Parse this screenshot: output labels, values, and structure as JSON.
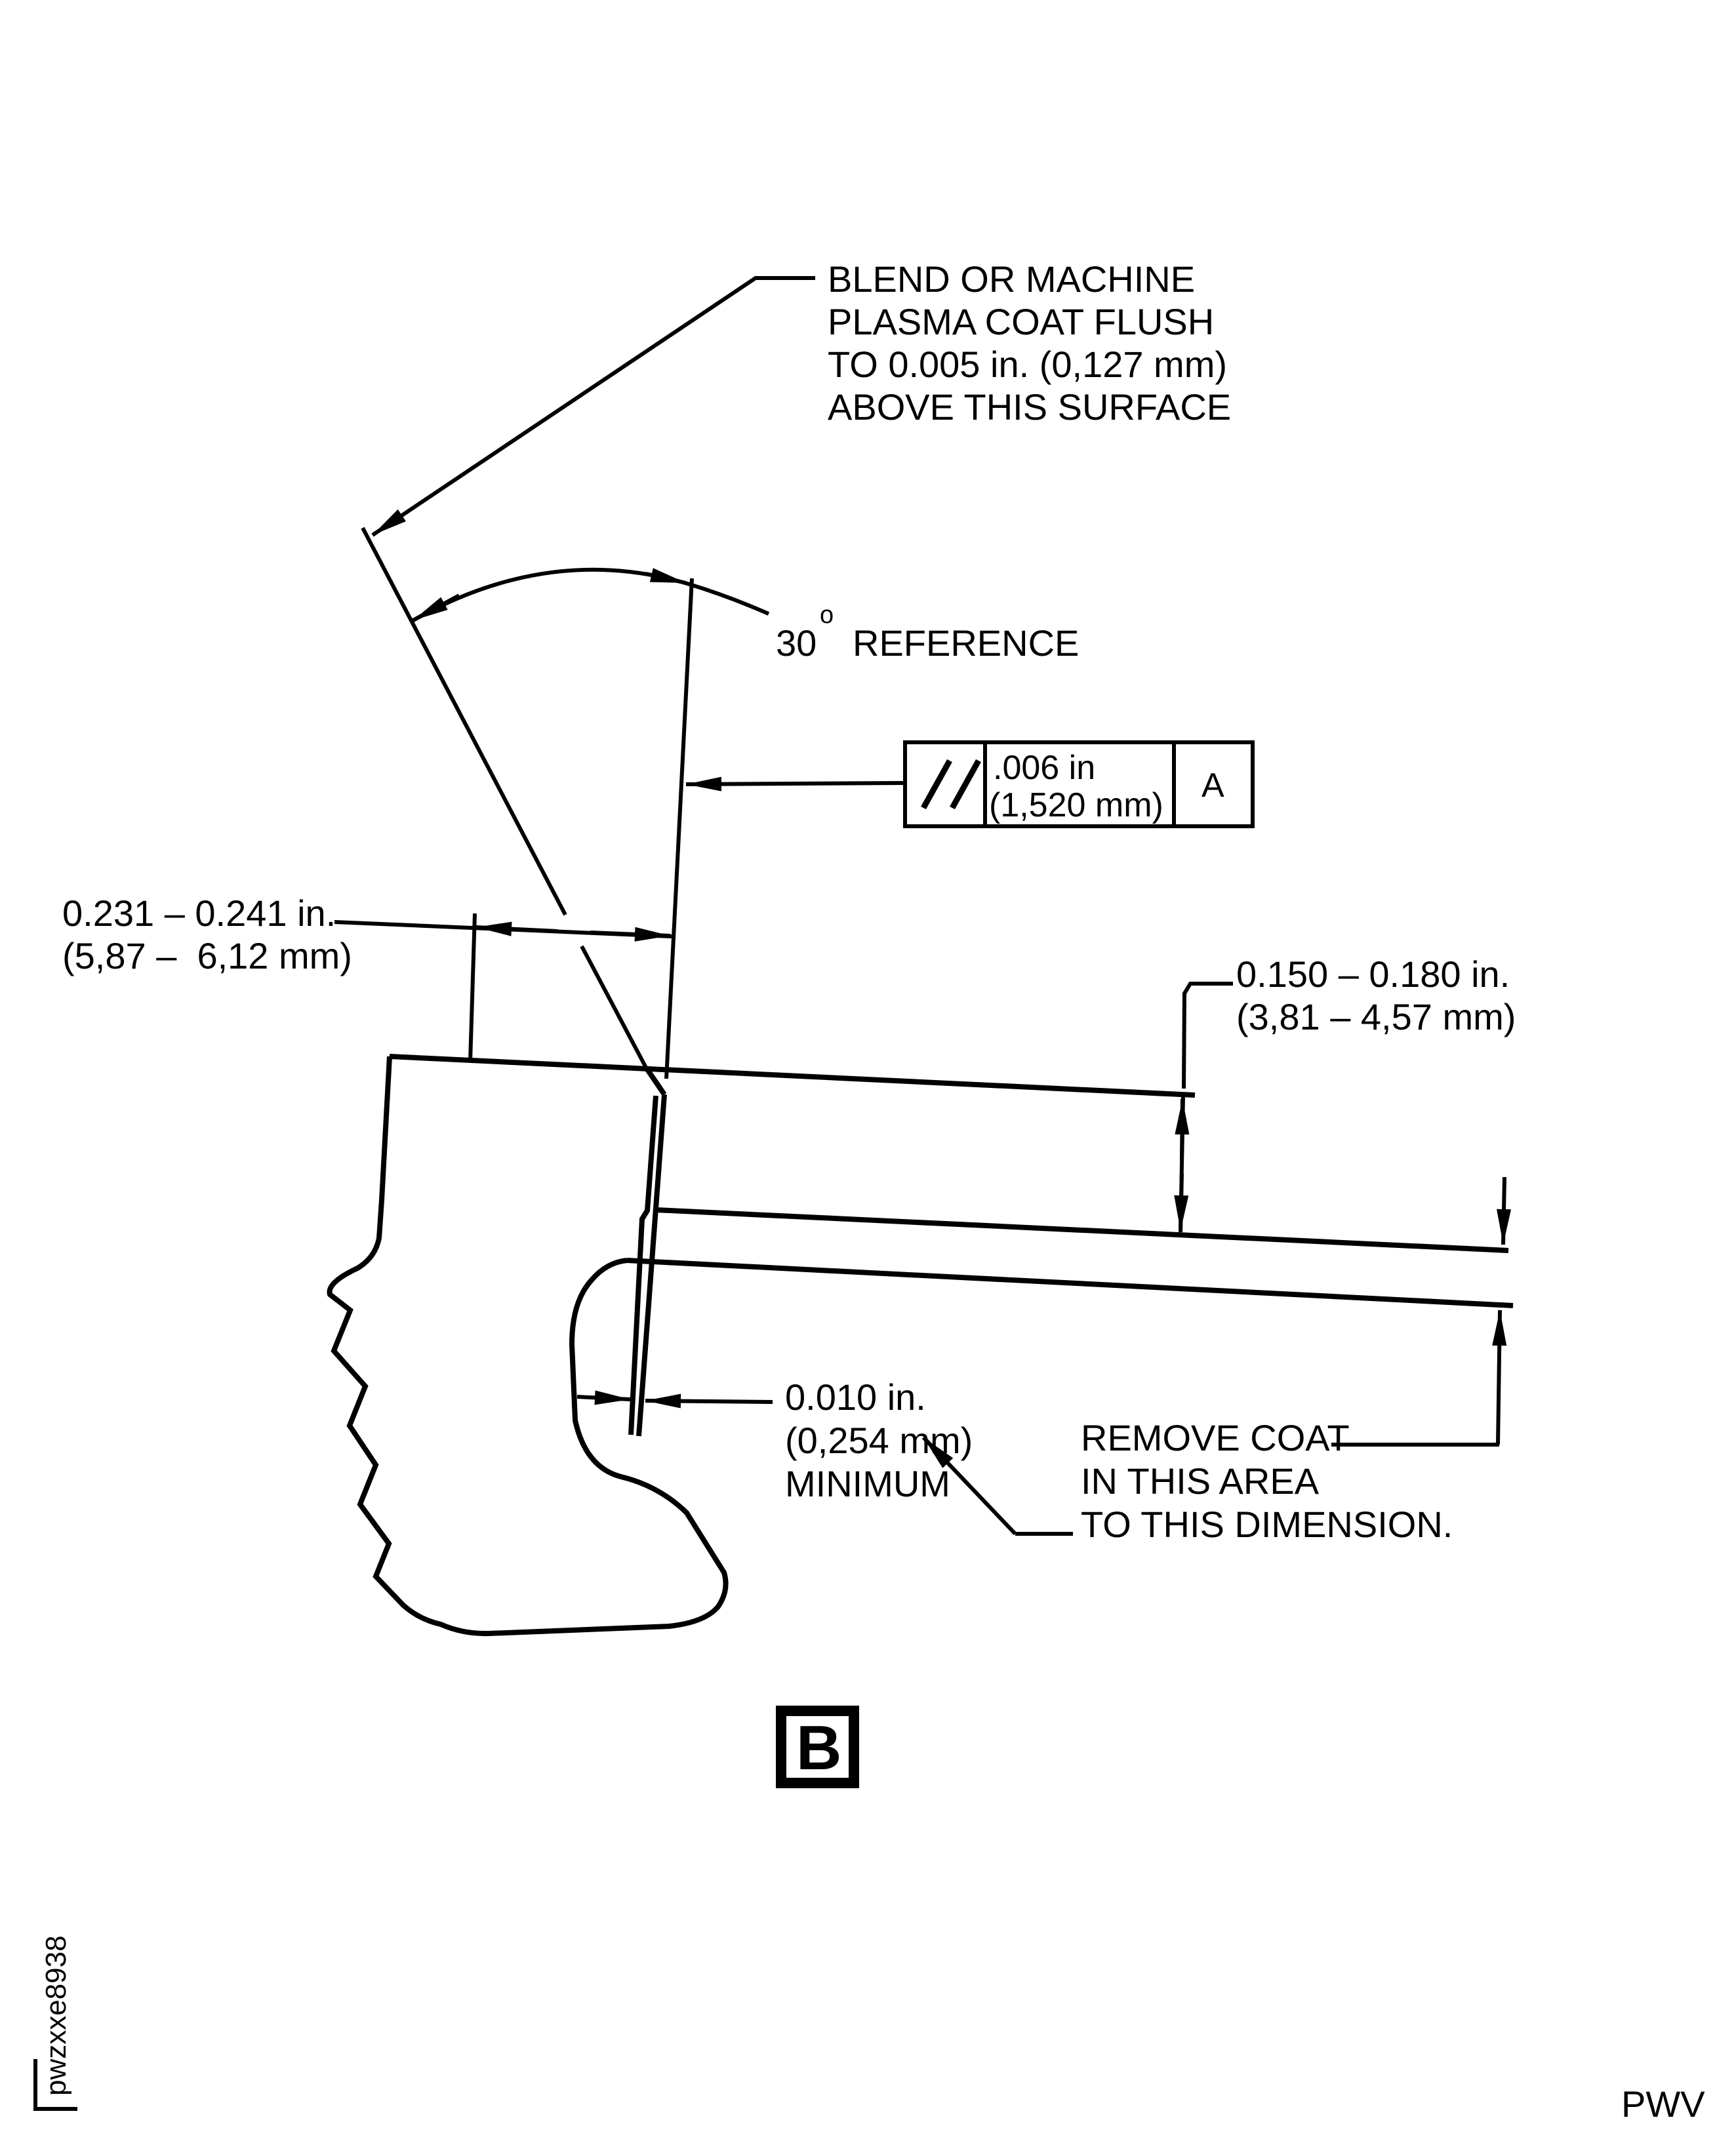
{
  "drawing": {
    "blend_note": {
      "l1": "BLEND OR MACHINE",
      "l2": "PLASMA COAT FLUSH",
      "l3": "TO 0.005 in. (0,127 mm)",
      "l4": "ABOVE THIS SURFACE"
    },
    "angle": {
      "value": "30",
      "sup": "o",
      "label": "REFERENCE"
    },
    "fcf": {
      "symbol_name": "parallelism-symbol",
      "tol1": ".006 in",
      "tol2": "(1,520 mm)",
      "datum": "A"
    },
    "width_dim": {
      "l1": "0.231 – 0.241 in.",
      "l2": "(5,87 –  6,12 mm)"
    },
    "coat_dim": {
      "l1": "0.150 – 0.180 in.",
      "l2": "(3,81 – 4,57 mm)"
    },
    "min_dim": {
      "l1": "0.010 in.",
      "l2": "(0,254 mm)",
      "l3": "MINIMUM"
    },
    "remove_note": {
      "l1": "REMOVE COAT",
      "l2": "IN THIS AREA",
      "l3": "TO THIS DIMENSION."
    },
    "detail": {
      "label": "B"
    },
    "footer": {
      "watermark": "pwzxxe8938",
      "code": "PWV"
    }
  }
}
